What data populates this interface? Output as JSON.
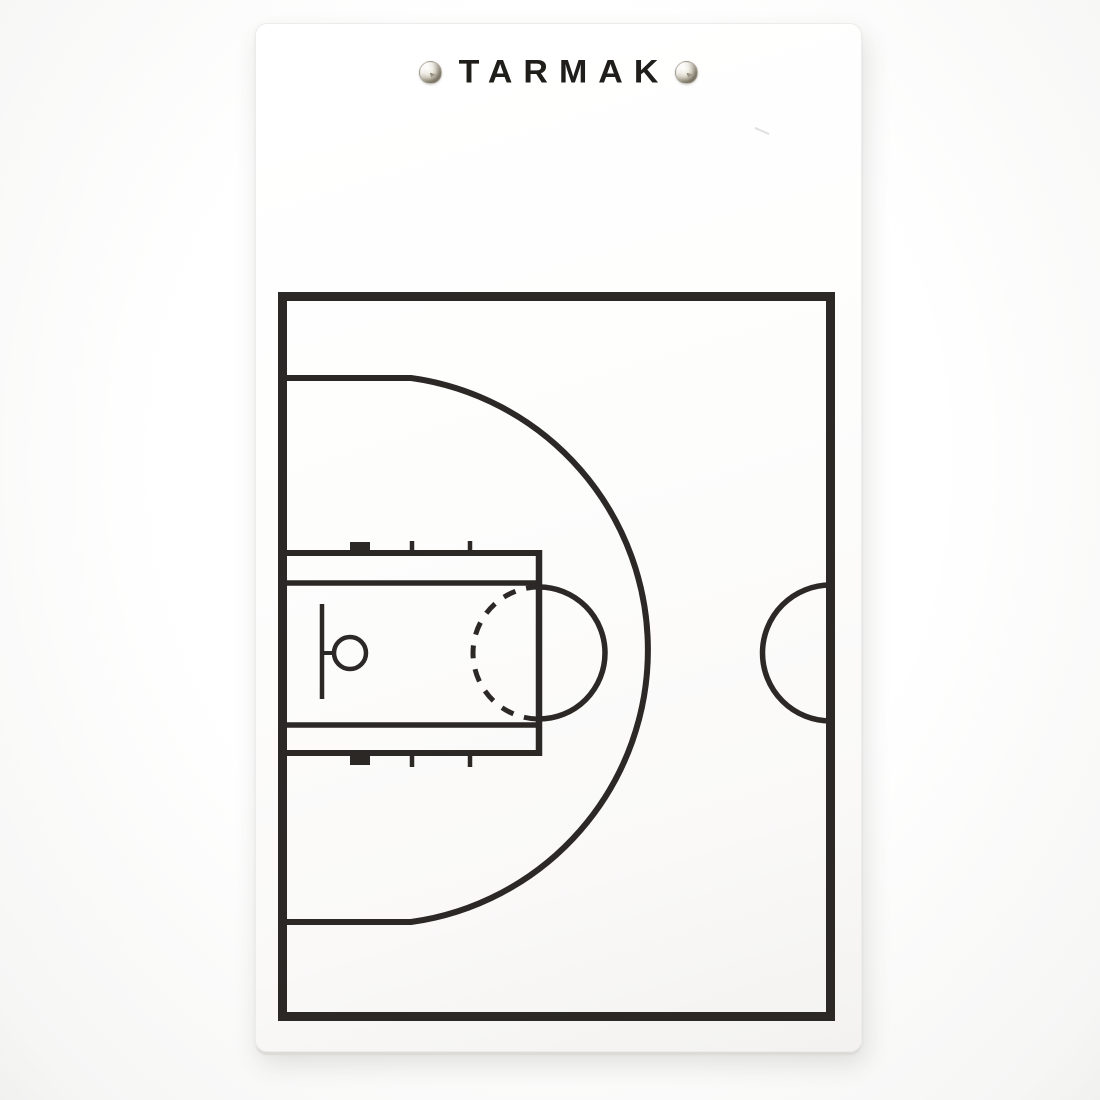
{
  "product_board": {
    "brand_text": "TARMAK",
    "hardware": {
      "fasteners": [
        "screw-icon",
        "screw-icon"
      ]
    },
    "colors": {
      "backdrop": "#fafaf9",
      "board_surface": "#fdfdfc",
      "court_lines": "#2b2826",
      "brand_text_color": "#201e1b"
    },
    "court_diagram": {
      "type": "basketball-half-court",
      "elements": [
        "court-boundary",
        "three-point-line",
        "lane-outer-rectangle",
        "lane-inner-rectangle",
        "free-throw-line",
        "free-throw-circle-solid-half",
        "free-throw-circle-dashed-half",
        "lane-hash-marks",
        "backboard",
        "rim",
        "half-court-center-circle"
      ]
    }
  }
}
